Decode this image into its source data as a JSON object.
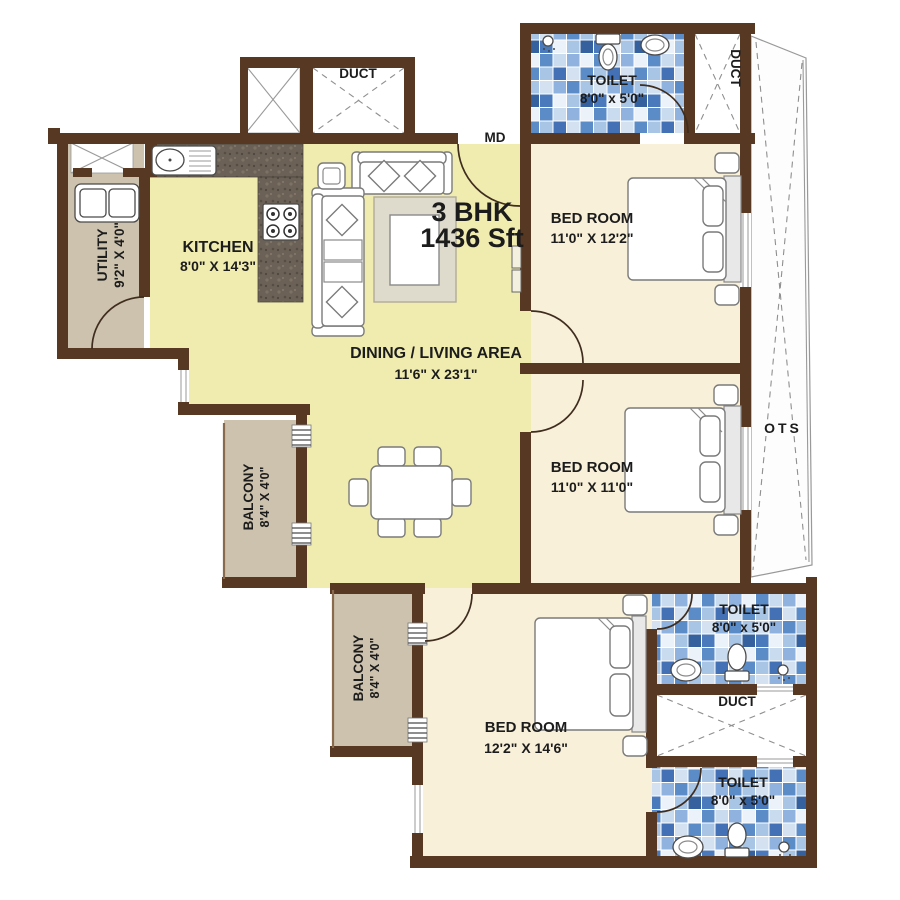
{
  "plan": {
    "title_line1": "3 BHK",
    "title_line2": "1436 Sft",
    "entrance_label": "MD",
    "ots_label": "OTS"
  },
  "rooms": {
    "utility": {
      "name": "UTILITY",
      "dims": "9'2\" X 4'0\""
    },
    "kitchen": {
      "name": "KITCHEN",
      "dims": "8'0\" X 14'3\""
    },
    "living": {
      "name": "DINING / LIVING AREA",
      "dims": "11'6\" X 23'1\""
    },
    "balcony1": {
      "name": "BALCONY",
      "dims": "8'4\" X 4'0\""
    },
    "balcony2": {
      "name": "BALCONY",
      "dims": "8'4\" X 4'0\""
    },
    "bedroom1": {
      "name": "BED ROOM",
      "dims": "11'0\" X 12'2\""
    },
    "bedroom2": {
      "name": "BED ROOM",
      "dims": "11'0\" X 11'0\""
    },
    "bedroom3": {
      "name": "BED ROOM",
      "dims": "12'2\" X 14'6\""
    },
    "toilet1": {
      "name": "TOILET",
      "dims": "8'0\" x 5'0\""
    },
    "toilet2": {
      "name": "TOILET",
      "dims": "8'0\" x 5'0\""
    },
    "toilet3": {
      "name": "TOILET",
      "dims": "8'0\" x 5'0\""
    },
    "duct_top": {
      "name": "DUCT"
    },
    "duct_right": {
      "name": "DUCT"
    },
    "duct_bottom": {
      "name": "DUCT"
    }
  },
  "colors": {
    "wall": "#573823",
    "floor_living": "#f0ecb0",
    "floor_bedroom": "#f8f0d9",
    "floor_balcony": "#cdc2ae",
    "tile_blue": "#5b8cc8",
    "counter_granite": "#6b6156"
  }
}
